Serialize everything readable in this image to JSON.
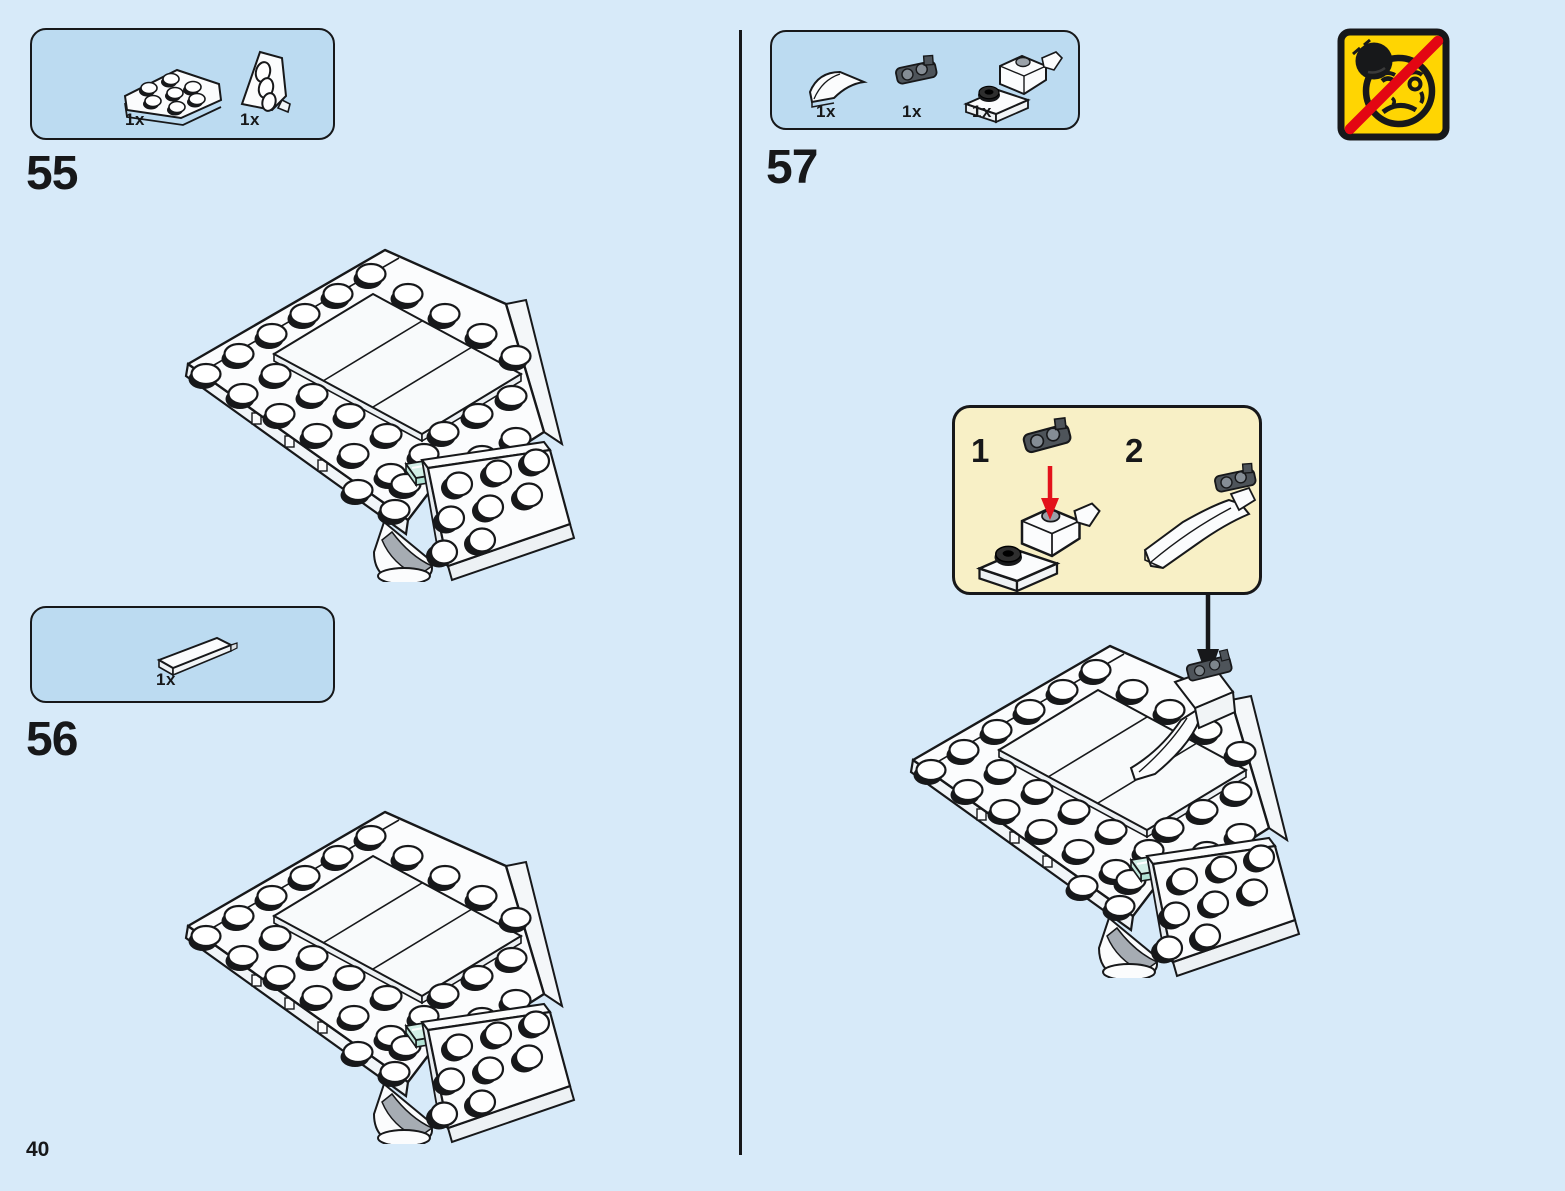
{
  "page_number": "40",
  "colors": {
    "background": "#D7EAF9",
    "parts_panel": "#BCDBF1",
    "callout_panel": "#F8F0C6",
    "warning_yellow": "#FFD502",
    "warning_red": "#E30613",
    "guide_arrow_red": "#E3121B",
    "trans_light_blue_piece": "#D2EFE6"
  },
  "steps": {
    "s55": {
      "number": "55",
      "parts": [
        {
          "icon": "wedge-plate-part",
          "count": "1x"
        },
        {
          "icon": "wedge-plate-right-part",
          "count": "1x"
        }
      ]
    },
    "s56": {
      "number": "56",
      "parts": [
        {
          "icon": "tile-1x4-part",
          "count": "1x"
        }
      ]
    },
    "s57": {
      "number": "57",
      "parts": [
        {
          "icon": "curved-slope-part",
          "count": "1x"
        },
        {
          "icon": "dark-clip-part",
          "count": "1x"
        },
        {
          "icon": "hinge-subassembly-part",
          "count": "1x"
        }
      ]
    }
  },
  "callout": {
    "substep1": "1",
    "substep2": "2"
  },
  "warning_icon": "do-not-drop-model-warning"
}
